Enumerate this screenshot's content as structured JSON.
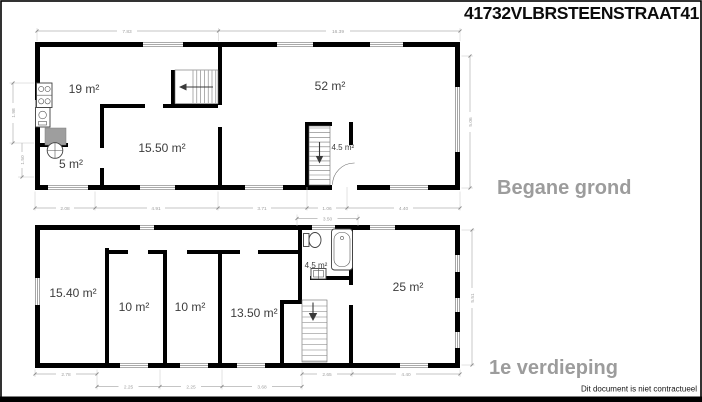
{
  "title": "41732VLBRSTEENSTRAAT41",
  "footer_note": "Dit document is niet contractueel",
  "colors": {
    "wall": "#000000",
    "caption": "#9c9c9c",
    "room_text": "#3d3d3d",
    "dimension": "#9f9f9f",
    "counter_fill": "#9e9e9e"
  },
  "ground_floor": {
    "caption": "Begane grond",
    "room_labels": {
      "kitchen": "19 m²",
      "living": "15.50 m²",
      "wc": "5 m²",
      "main": "52 m²",
      "stair": "4.5 m²"
    },
    "dims": {
      "top_left": "7.83",
      "top_right": "16.39",
      "b1": "2.08",
      "b2": "4.91",
      "b3": "3.71",
      "b4": "1.06",
      "b5": "4.40",
      "right": "5.06",
      "left_upper": "1.98",
      "left_lower": "1.50"
    }
  },
  "first_floor": {
    "caption": "1e verdieping",
    "room_labels": {
      "r1": "15.40 m²",
      "r2": "10 m²",
      "r3": "10 m²",
      "r4": "13.50 m²",
      "bath": "4.5 m²",
      "r5": "25 m²"
    },
    "dims": {
      "top": "3.50",
      "b1": "2.78",
      "b2": "2.25",
      "b3": "2.25",
      "b4": "3.68",
      "b5": "2.65",
      "b6": "4.40",
      "right": "5.51"
    }
  }
}
